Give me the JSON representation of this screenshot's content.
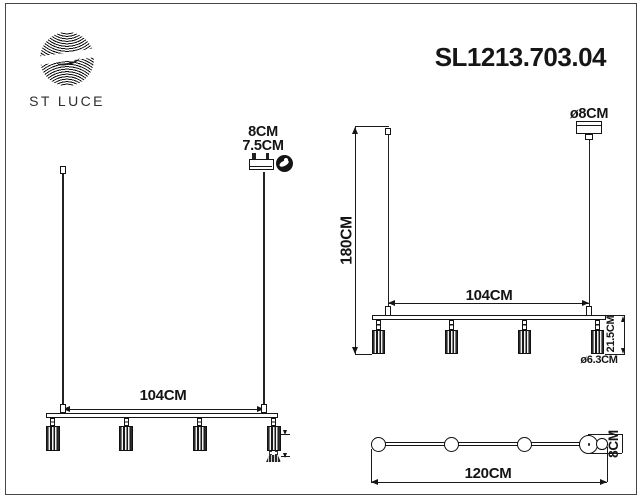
{
  "meta": {
    "brand": "ST LUCE",
    "model": "SL1213.703.04"
  },
  "front_view": {
    "canopy_width": "8CM",
    "canopy_depth": "7.5CM",
    "bar_length": "104CM"
  },
  "side_view": {
    "overall_drop": "180CM",
    "canopy_diameter": "ø8CM",
    "bar_length": "104CM",
    "lamp_height": "21.5CM",
    "lamp_diameter": "ø6.3CM"
  },
  "top_view": {
    "overall_length": "120CM",
    "canopy_diameter": "8CM"
  },
  "colors": {
    "line": "#1a1a1a",
    "frame": "#474747",
    "background": "#ffffff"
  },
  "icons": {
    "hand_adjust": "hand-adjust-icon",
    "bulb": "gu10-bulb"
  }
}
